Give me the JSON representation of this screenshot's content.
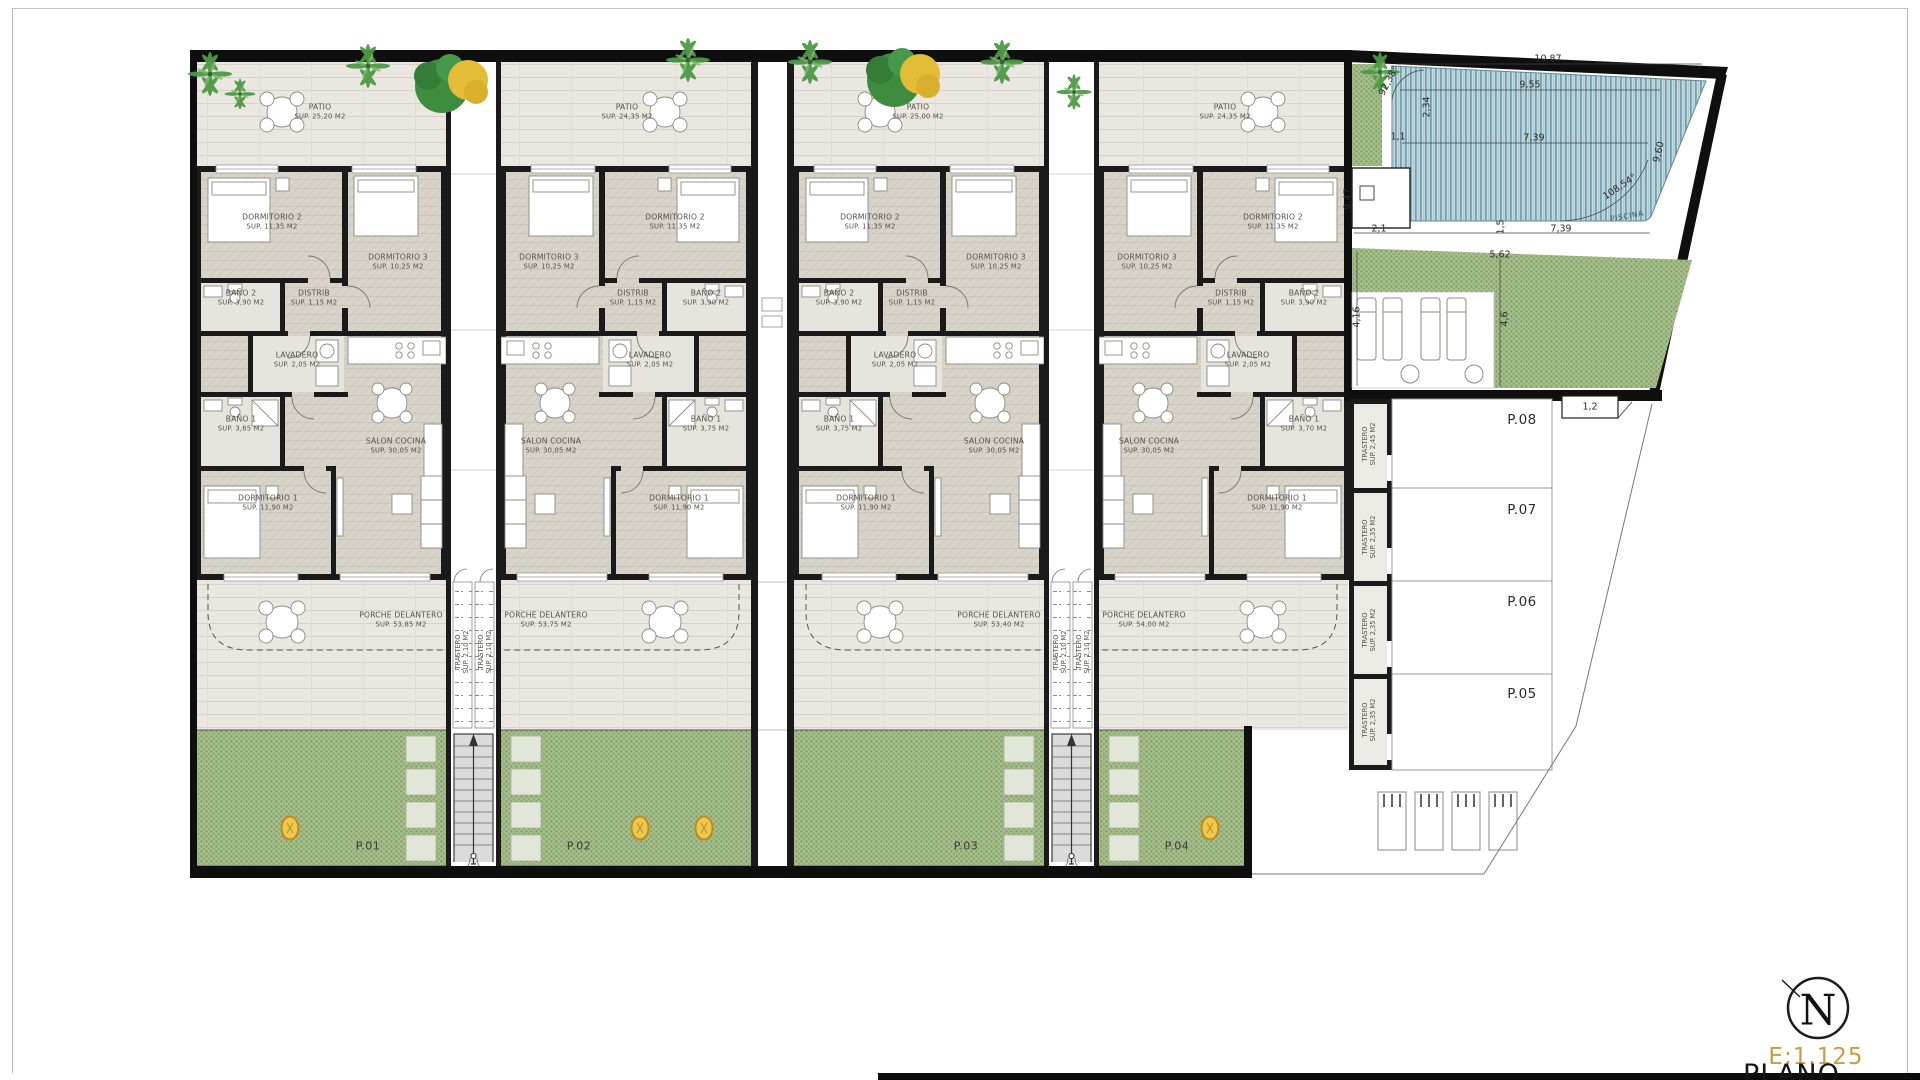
{
  "plan": {
    "units": [
      {
        "plot": "P.01",
        "patio_name": "PATIO",
        "patio_sup": "SUP. 25,20 M2",
        "dorm2_name": "DORMITORIO 2",
        "dorm2_sup": "SUP. 11,35 M2",
        "dorm3_name": "DORMITORIO 3",
        "dorm3_sup": "SUP. 10,25 M2",
        "bano2_name": "BAÑO 2",
        "bano2_sup": "SUP. 3,90 M2",
        "distrib_name": "DISTRIB",
        "distrib_sup": "SUP. 1,15 M2",
        "lavadero_name": "LAVADERO",
        "lavadero_sup": "SUP. 2,05 M2",
        "bano1_name": "BAÑO 1",
        "bano1_sup": "SUP. 3,65 M2",
        "salon_name": "SALON COCINA",
        "salon_sup": "SUP. 30,05 M2",
        "dorm1_name": "DORMITORIO 1",
        "dorm1_sup": "SUP. 11,90 M2",
        "porche_name": "PORCHE DELANTERO",
        "porche_sup": "SUP. 53,85 M2"
      },
      {
        "plot": "P.02",
        "patio_name": "PATIO",
        "patio_sup": "SUP. 24,35 M2",
        "dorm2_name": "DORMITORIO 2",
        "dorm2_sup": "SUP. 11,35 M2",
        "dorm3_name": "DORMITORIO 3",
        "dorm3_sup": "SUP. 10,25 M2",
        "bano2_name": "BAÑO 2",
        "bano2_sup": "SUP. 3,90 M2",
        "distrib_name": "DISTRIB",
        "distrib_sup": "SUP. 1,15 M2",
        "lavadero_name": "LAVADERO",
        "lavadero_sup": "SUP. 2,05 M2",
        "bano1_name": "BAÑO 1",
        "bano1_sup": "SUP. 3,75 M2",
        "salon_name": "SALON COCINA",
        "salon_sup": "SUP. 30,05 M2",
        "dorm1_name": "DORMITORIO 1",
        "dorm1_sup": "SUP. 11,90 M2",
        "porche_name": "PORCHE DELANTERO",
        "porche_sup": "SUP. 53,75 M2"
      },
      {
        "plot": "P.03",
        "patio_name": "PATIO",
        "patio_sup": "SUP. 25,00 M2",
        "dorm2_name": "DORMITORIO 2",
        "dorm2_sup": "SUP. 11,35 M2",
        "dorm3_name": "DORMITORIO 3",
        "dorm3_sup": "SUP. 10,25 M2",
        "bano2_name": "BAÑO 2",
        "bano2_sup": "SUP. 3,90 M2",
        "distrib_name": "DISTRIB",
        "distrib_sup": "SUP. 1,15 M2",
        "lavadero_name": "LAVADERO",
        "lavadero_sup": "SUP. 2,05 M2",
        "bano1_name": "BAÑO 1",
        "bano1_sup": "SUP. 3,75 M2",
        "salon_name": "SALON COCINA",
        "salon_sup": "SUP. 30,05 M2",
        "dorm1_name": "DORMITORIO 1",
        "dorm1_sup": "SUP. 11,90 M2",
        "porche_name": "PORCHE DELANTERO",
        "porche_sup": "SUP. 53,40 M2"
      },
      {
        "plot": "P.04",
        "patio_name": "PATIO",
        "patio_sup": "SUP. 24,35 M2",
        "dorm2_name": "DORMITORIO 2",
        "dorm2_sup": "SUP. 11,35 M2",
        "dorm3_name": "DORMITORIO 3",
        "dorm3_sup": "SUP. 10,25 M2",
        "bano2_name": "BAÑO 2",
        "bano2_sup": "SUP. 3,90 M2",
        "distrib_name": "DISTRIB",
        "distrib_sup": "SUP. 1,15 M2",
        "lavadero_name": "LAVADERO",
        "lavadero_sup": "SUP. 2,05 M2",
        "bano1_name": "BAÑO 1",
        "bano1_sup": "SUP. 3,70 M2",
        "salon_name": "SALON COCINA",
        "salon_sup": "SUP. 30,05 M2",
        "dorm1_name": "DORMITORIO 1",
        "dorm1_sup": "SUP. 11,90 M2",
        "porche_name": "PORCHE DELANTERO",
        "porche_sup": "SUP. 54,00 M2"
      }
    ],
    "stair_storage": {
      "name": "TRASTERO",
      "sup": "SUP. 2,10 M2"
    },
    "storage_units": [
      {
        "plot": "P.08",
        "name": "TRASTERO",
        "sup": "SUP. 2,45 M2"
      },
      {
        "plot": "P.07",
        "name": "TRASTERO",
        "sup": "SUP. 2,35 M2"
      },
      {
        "plot": "P.06",
        "name": "TRASTERO",
        "sup": "SUP. 2,35 M2"
      },
      {
        "plot": "P.05",
        "name": "TRASTERO",
        "sup": "SUP. 2,35 M2"
      }
    ],
    "pool": {
      "label": "PISCINA"
    },
    "dims": [
      "10,87",
      "9,55",
      "7,39",
      "2,34",
      "1,1",
      "92,38°",
      "108,54°",
      "9,60",
      "2,1",
      "1,5",
      "7,39",
      "9,47",
      "4,16",
      "5,62",
      "4,6",
      "1,2"
    ]
  },
  "titleblock": {
    "north": "N",
    "scale": "E:1.125",
    "plano": "PLANO Nº"
  }
}
